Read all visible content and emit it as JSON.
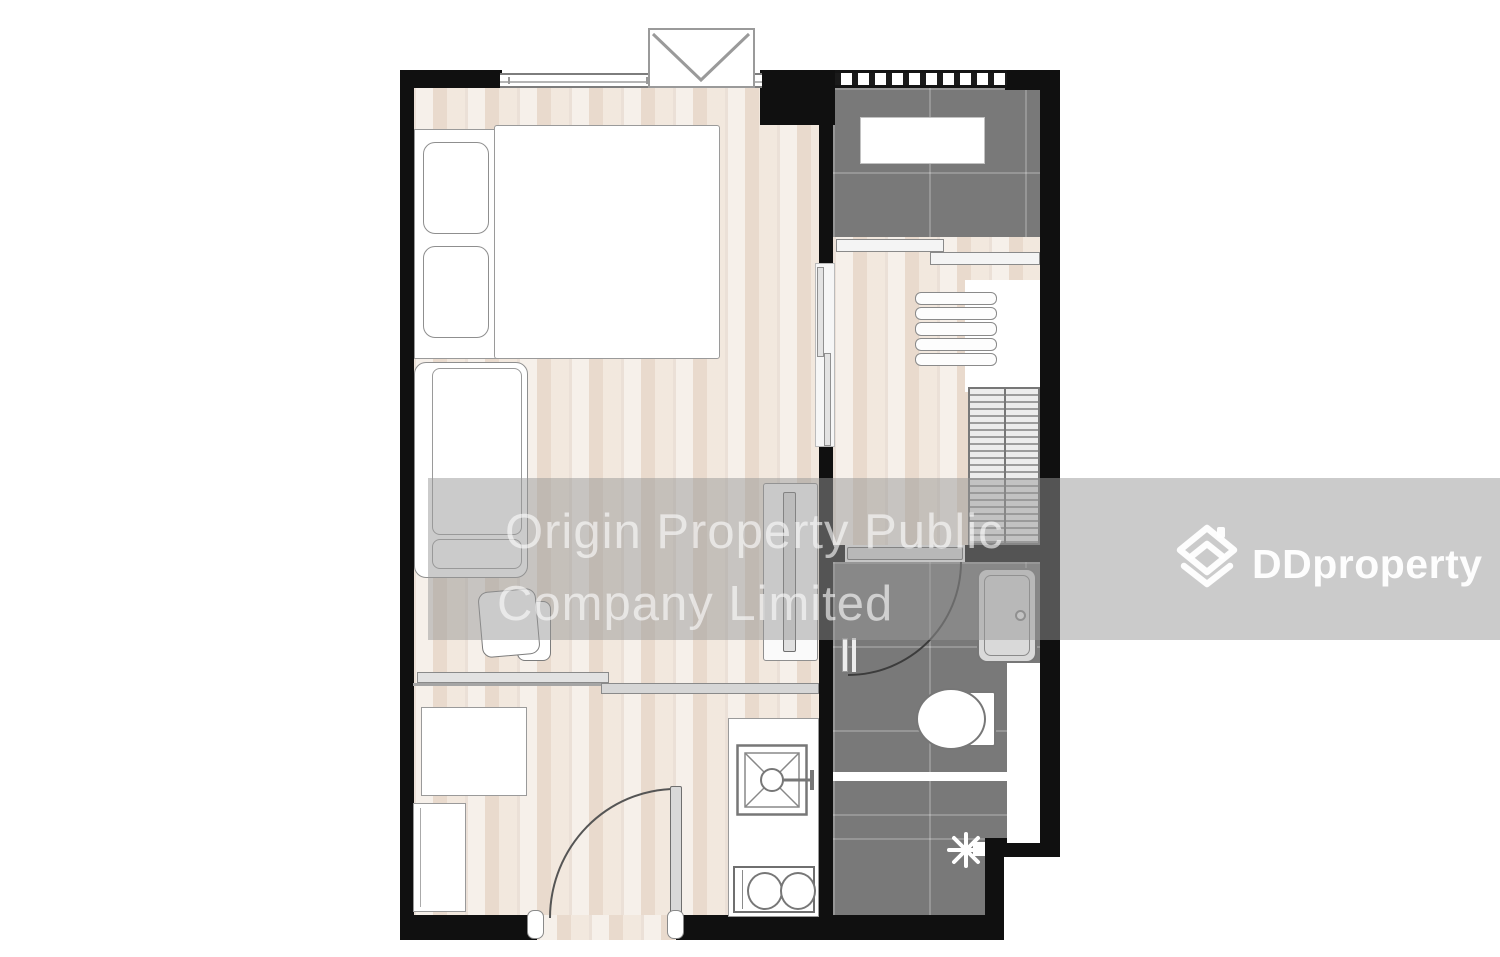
{
  "watermark": {
    "line1": "Origin Property Public",
    "line2": "Company Limited"
  },
  "brand": {
    "name": "DDproperty",
    "icon": "house-chevron-icon"
  },
  "palette": {
    "wall": "#101010",
    "wood": "#efe4d9",
    "tile": "#797979",
    "band": "rgba(151,151,151,0.5)",
    "wmtext": "rgba(252,252,252,0.62)",
    "brand": "rgba(255,255,255,0.95)",
    "arc": "#3c3c3c"
  },
  "plan": {
    "type": "floor-plan",
    "rooms": [
      "bedroom-living",
      "balcony",
      "dressing-area",
      "bathroom",
      "kitchen-entrance"
    ],
    "fixtures": [
      "bed",
      "pillows",
      "sofa",
      "stool",
      "tv-console",
      "ac-condenser",
      "balcony-unit",
      "wardrobe-shelves",
      "wardrobe-hanging",
      "vanity-sink",
      "toilet",
      "shower-head",
      "kitchen-sink",
      "stove-two-burners",
      "dining-table",
      "fridge-cabinet",
      "entrance-swing-door",
      "bathroom-swing-door",
      "sliding-glass-doors",
      "window"
    ]
  }
}
